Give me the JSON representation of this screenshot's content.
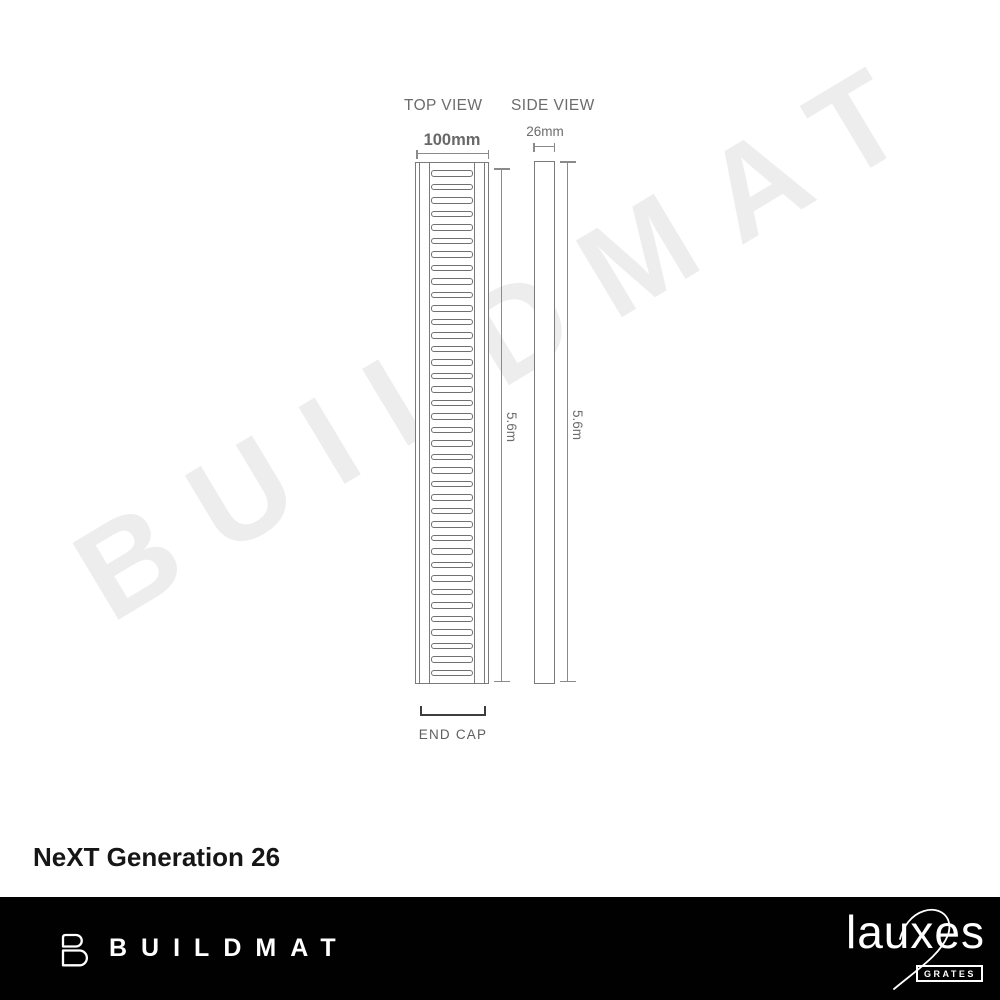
{
  "watermark": {
    "text": "BUILDMAT"
  },
  "diagram": {
    "top_view": {
      "title": "TOP VIEW",
      "width_label": "100mm",
      "length_label": "5.6m",
      "slot_count": 38
    },
    "side_view": {
      "title": "SIDE VIEW",
      "width_label": "26mm",
      "length_label": "5.6m"
    },
    "end_cap": {
      "label": "END CAP"
    }
  },
  "product_title": "NeXT Generation 26",
  "footer": {
    "buildmat_logo": "BUILDMAT",
    "lauxes_logo": "lauxes",
    "lauxes_sub": "GRATES"
  },
  "colors": {
    "diagram_line": "#7a7a7a",
    "dimension_line": "#8a8a8a",
    "label_text": "#6c6c6c",
    "end_cap_bracket": "#3d3d3d",
    "watermark": "#ededed",
    "footer_background": "#010101",
    "footer_text": "#ffffff"
  }
}
